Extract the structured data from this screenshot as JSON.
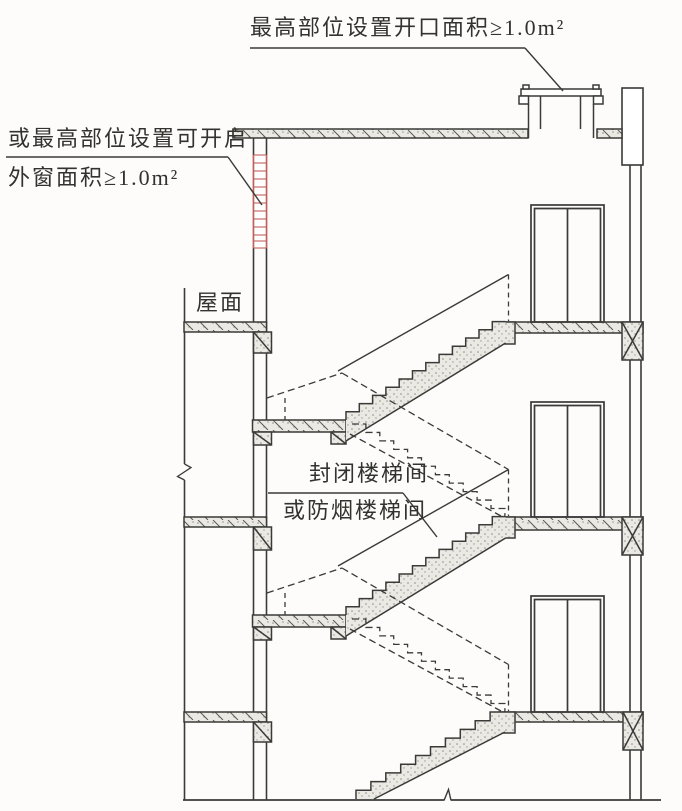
{
  "drawing": {
    "type": "building-stair-section",
    "annotations": {
      "top_note": "最高部位设置开口面积≥1.0m²",
      "left_note_line1": "或最高部位设置可开启",
      "left_note_line2": "外窗面积≥1.0m²",
      "roof_label": "屋面",
      "stair_note_line1": "封闭楼梯间",
      "stair_note_line2": "或防烟楼梯间"
    },
    "colors": {
      "line": "#3a3a38",
      "ink": "#32322f",
      "paper": "#fdfcfa",
      "concrete_fill": "#ebe9e3",
      "stipple_dot": "#8f8d85",
      "window_red": "#c4605c"
    }
  }
}
